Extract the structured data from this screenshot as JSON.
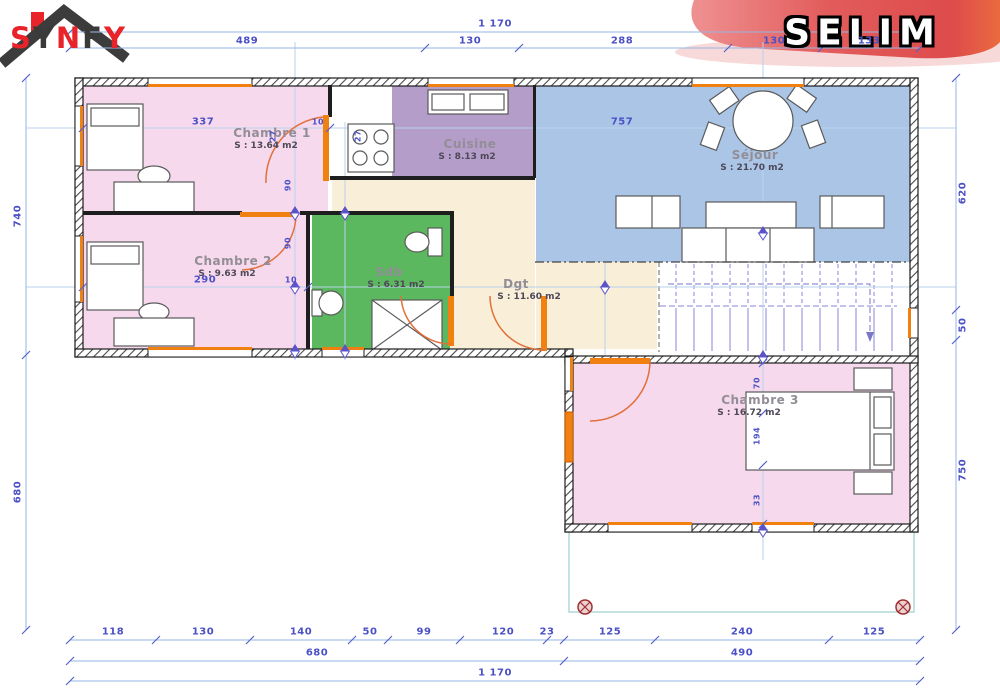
{
  "logo": {
    "brand": "SYNFY",
    "letters": [
      {
        "ch": "S"
      },
      {
        "ch": "Y"
      },
      {
        "ch": "N"
      },
      {
        "ch": "F"
      },
      {
        "ch": "Y"
      }
    ]
  },
  "banner": {
    "title": "SELIM"
  },
  "rooms": {
    "chambre1": {
      "name": "Chambre 1",
      "area": "S : 13.64 m2"
    },
    "chambre2": {
      "name": "Chambre 2",
      "area": "S : 9.63 m2"
    },
    "cuisine": {
      "name": "Cuisine",
      "area": "S : 8.13 m2"
    },
    "sejour": {
      "name": "Séjour",
      "area": "S : 21.70 m2"
    },
    "sdb": {
      "name": "Sdb",
      "area": "S : 6.31 m2"
    },
    "dgt": {
      "name": "Dgt",
      "area": "S : 11.60 m2"
    },
    "chambre3": {
      "name": "Chambre 3",
      "area": "S : 16.72 m2"
    }
  },
  "dims": {
    "top_total": "1 170",
    "top_segments": [
      "489",
      "130",
      "288",
      "130",
      "133"
    ],
    "bottom_segments": [
      "118",
      "130",
      "140",
      "50",
      "99",
      "120",
      "23",
      "125",
      "240",
      "125"
    ],
    "bottom_subtotals": [
      "680",
      "490"
    ],
    "bottom_total": "1 170",
    "left": [
      "740",
      "680"
    ],
    "right": [
      "620",
      "50",
      "750"
    ],
    "interior": {
      "chambre1_w": "337",
      "door1": "10",
      "sejour_w": "757",
      "chambre2_w": "290",
      "door2": "10",
      "wall_a": "27",
      "wall_b": "27",
      "jamb_a": "90",
      "jamb_b": "90",
      "c3_a": "70",
      "c3_b": "194",
      "c3_c": "33"
    }
  },
  "colors": {
    "wall": "#1b1b1b",
    "room_pink": "#f7d9ee",
    "room_mauve": "#b49dc9",
    "room_blue": "#abc5e7",
    "room_green": "#5cb85f",
    "room_beige": "#f9efd8",
    "accent_orange": "#f08010",
    "dim_line": "#96b6e4",
    "dim_text": "#4b50c5",
    "ribbon_red": "#e25b5b",
    "logo_red": "#e8232a",
    "logo_dark": "#3a3a3a"
  }
}
